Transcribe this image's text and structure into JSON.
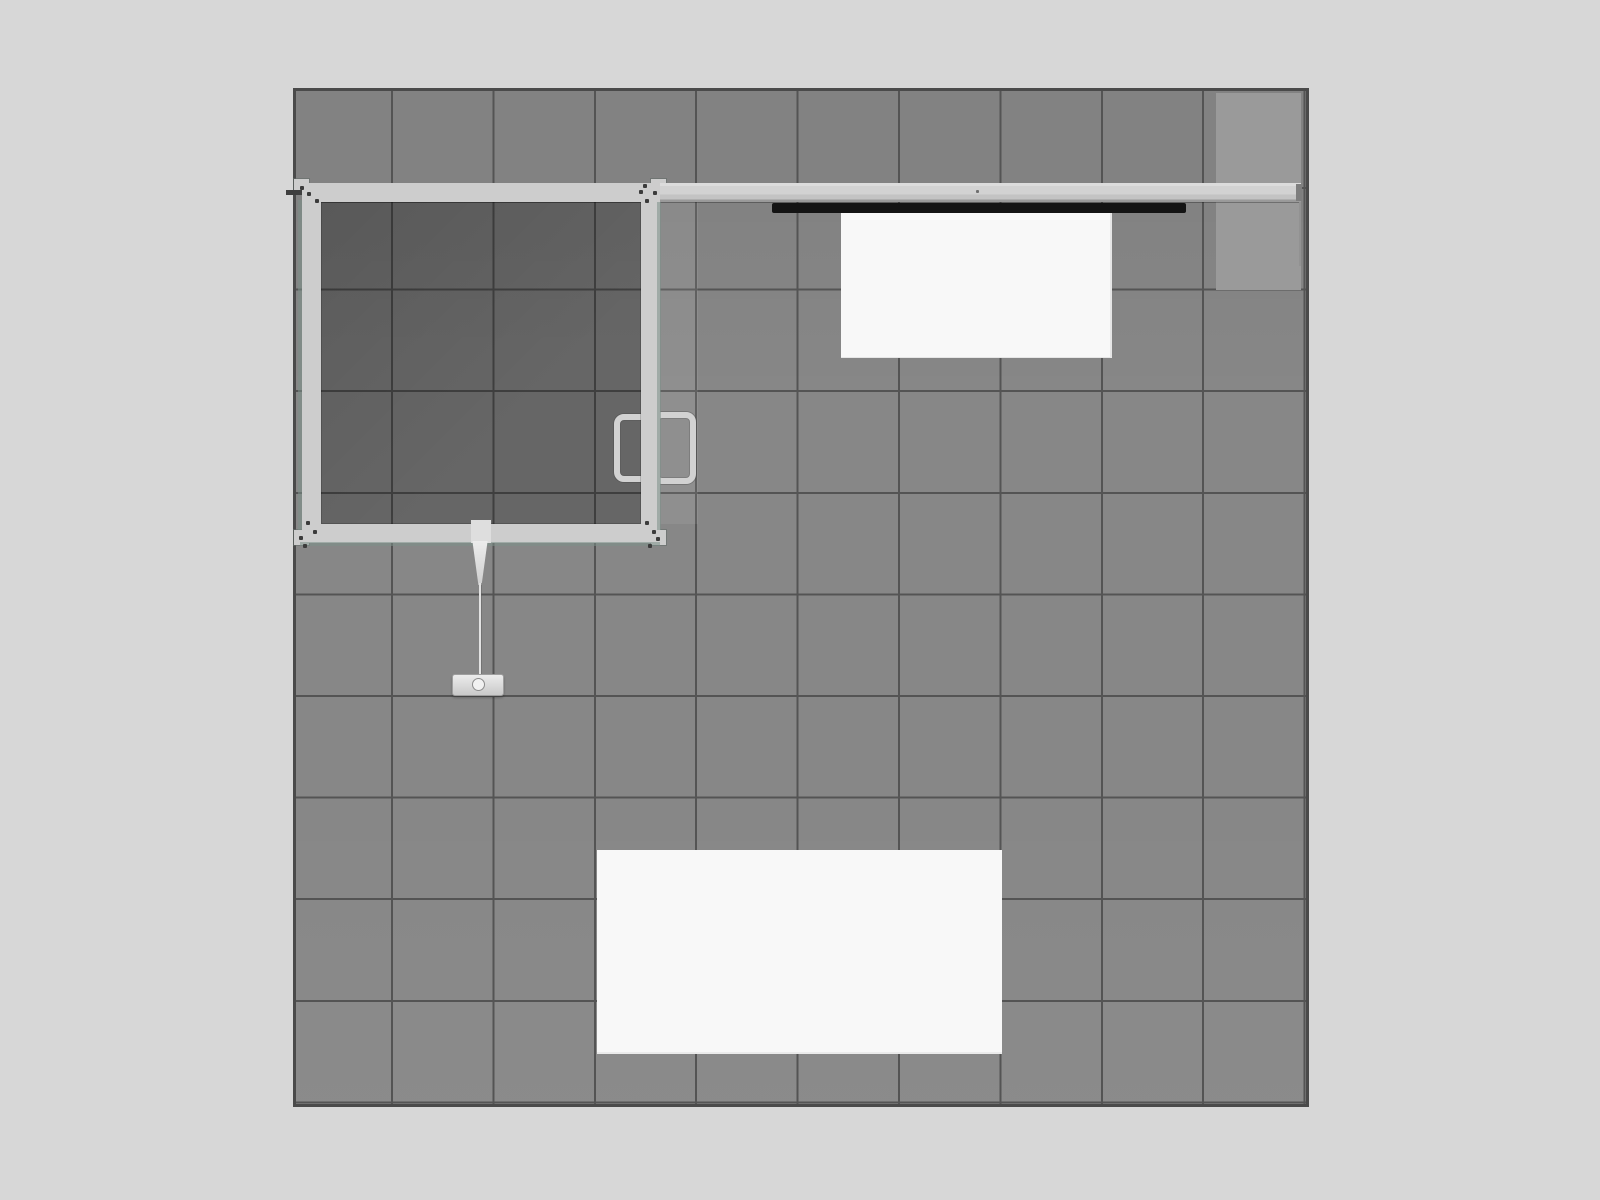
{
  "scene": {
    "title": "Top-down plan render of a 10x10 trade-show booth",
    "floor_grid": {
      "columns": 10,
      "rows": 10,
      "tile_shape": "square"
    },
    "elements": {
      "booth_floor": "gray tiled floor area with dark outline",
      "light_floor_patch": "lighter floor rectangle in top-right corner",
      "back_wall_beam": "light gray wall beam running along the top edge",
      "monitor_bar": "black flat bar mounted on back wall",
      "hanging_counter": "white rectangular counter below monitor bar",
      "closet_frame": "square walled closet room, top-left, with darker floor",
      "door_pulls": "two C-shaped pull handles on closet door, inside and outside",
      "pendant_light": "cone, cord and base plate hanging below closet",
      "booth_table": "large white rectangle in lower-center of floor",
      "corner_plates": "frame corner plates with screw dots",
      "wall_stub": "short wall line at right end of beam",
      "left_wall_tick": "dark tick crossing left floor edge at beam height"
    }
  },
  "colors": {
    "canvas_bg": "#d7d7d7",
    "floor_border": "#4a4a4a",
    "tile": "#878787",
    "grid_line": "#545454",
    "closet_floor_tint": "rgba(0,0,0,0.24)",
    "frame": "#cdcdcd",
    "frame_edge": "#9a9a9a",
    "teal_edge": "rgba(123,143,137,0.55)",
    "light_patch": "#9a9a9a",
    "door_band": "rgba(255,255,255,0.07)",
    "monitor": "#141414",
    "counter": "#f8f8f8",
    "table": "#f8f8f8",
    "handle": "#d2d2d2",
    "pendant": "#dcdcdc",
    "screw": "#3b3b3b",
    "tick": "#3f3f3f",
    "beam_cap": "#7e7e7e",
    "wall_stub": "#929292"
  }
}
